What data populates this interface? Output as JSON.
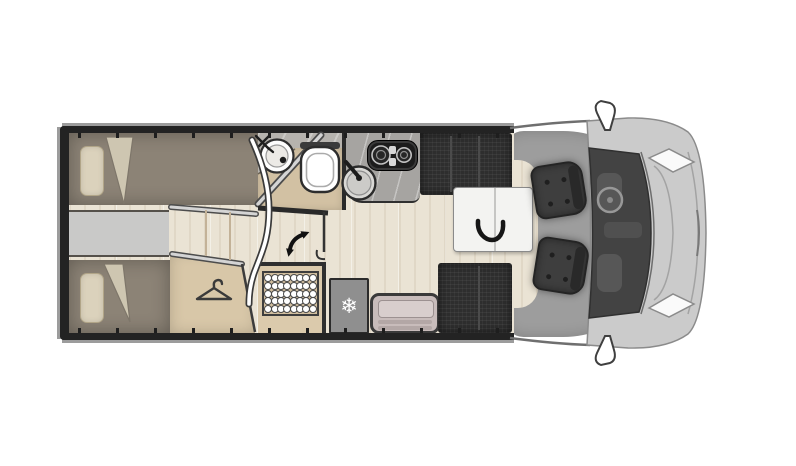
{
  "floorplan": {
    "view": "motorhome top-down layout, cab facing right",
    "rooms": [
      "rear-twin-bedroom",
      "wardrobe",
      "bedroom-steps",
      "bathroom",
      "shower",
      "kitchen",
      "entry",
      "dinette",
      "cab"
    ],
    "furniture": [
      "twin-bed-top",
      "twin-bed-bottom",
      "pillow",
      "pillow",
      "wardrobe-with-hanger",
      "washbasin",
      "toilet",
      "kitchen-sink",
      "two-burner-stove",
      "fridge",
      "shower-mat",
      "entry-bench",
      "dinette-bench-rear",
      "dinette-bench-front",
      "folding-table",
      "swivel-chair-driver",
      "swivel-chair-passenger"
    ],
    "icons": {
      "fridge_glyph": "❄",
      "hanger": "coat-hanger",
      "door_swing": "curved-double-arrow",
      "table_fold": "curved-arrow"
    }
  },
  "shower_mat": {
    "rows": 5,
    "cols": 8
  },
  "wall_ticks": {
    "count": 12
  },
  "colors": {
    "wall": "#232323",
    "trim": "#9c9c9c",
    "wood": "#eae3d4",
    "aisle": "#c9c9c8",
    "bed": "#8c8376",
    "pillow": "#dbd2bc",
    "pillowEdge": "#b1a588",
    "fold": "#cec6b1",
    "wardrobe": "#d8c7a8",
    "tile": "#b6b3ae",
    "counter": "#d2c1a3",
    "marble": "#a6a4a1",
    "showerFloor": "#dbcaac",
    "matBg": "#d2bf9f",
    "fridge": "#8f8f8f",
    "seat": "#2e2e2e",
    "seam": "#4b4b4b",
    "tableTop": "#f3f3f1",
    "chair": "#3e3e3e",
    "cabFloor": "#9d9d9d",
    "vanBody": "#cbcbcb",
    "windshield": "#434343",
    "bench": "#c8bcbb",
    "benchInner": "#d8cecd",
    "benchSlat": "#b3a7a6"
  }
}
